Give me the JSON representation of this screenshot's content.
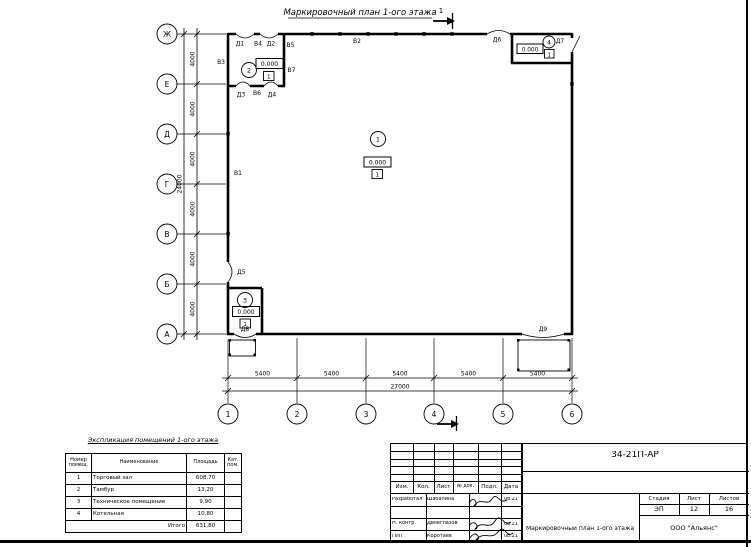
{
  "plan": {
    "title": "Маркировочный план 1-ого этажа",
    "section": "1",
    "axis_rows": [
      "Ж",
      "Е",
      "Д",
      "Г",
      "В",
      "Б",
      "А"
    ],
    "axis_cols": [
      "1",
      "2",
      "3",
      "4",
      "5",
      "6"
    ],
    "dim_step_v": "4000",
    "dim_total_v": "24000",
    "dim_step_h": "5400",
    "dim_total_h": "27000",
    "elevation": "0.000",
    "floor_mark": "1",
    "room_numbers": [
      "1",
      "2",
      "3",
      "4"
    ],
    "doors": [
      "Д1",
      "Д2",
      "Д3",
      "Д4",
      "Д5",
      "Д6",
      "Д7",
      "Д8",
      "Д9"
    ],
    "windows": [
      "В1",
      "В2",
      "В3",
      "В4",
      "В5",
      "В6",
      "В7"
    ]
  },
  "explication": {
    "title": "Экспликация помещений 1-ого этажа",
    "col_num": "Номер помещ.",
    "col_name": "Наименование",
    "col_area": "Площадь",
    "col_cat": "Кат. пом.",
    "rows": [
      [
        "1",
        "Торговый зал",
        "608,70"
      ],
      [
        "2",
        "Тамбур",
        "13,20"
      ],
      [
        "3",
        "Техническое помещение",
        "9,90"
      ],
      [
        "4",
        "Котельная",
        "10,80"
      ]
    ],
    "total_label": "Итого",
    "total_value": "631,80"
  },
  "titleblock": {
    "doc_number": "34-21П-АР",
    "col_headers": [
      "Изм.",
      "Кол.",
      "Лист",
      "№ док.",
      "Подл.",
      "Дата"
    ],
    "staff": [
      {
        "role": "Разработал",
        "name": "Шабалина",
        "date": "08.21"
      },
      {
        "role": "Н. контр.",
        "name": "Двоеглазов",
        "date": "08.21"
      },
      {
        "role": "ГИП",
        "name": "Коротаев",
        "date": "08.21"
      }
    ],
    "stage_label": "Стадия",
    "sheet_label": "Лист",
    "sheets_label": "Листов",
    "stage": "ЭП",
    "sheet_num": "12",
    "sheets_total": "16",
    "drawing_name": "Маркировочный план 1-ого этажа",
    "company": "ООО \"Альянс\""
  }
}
